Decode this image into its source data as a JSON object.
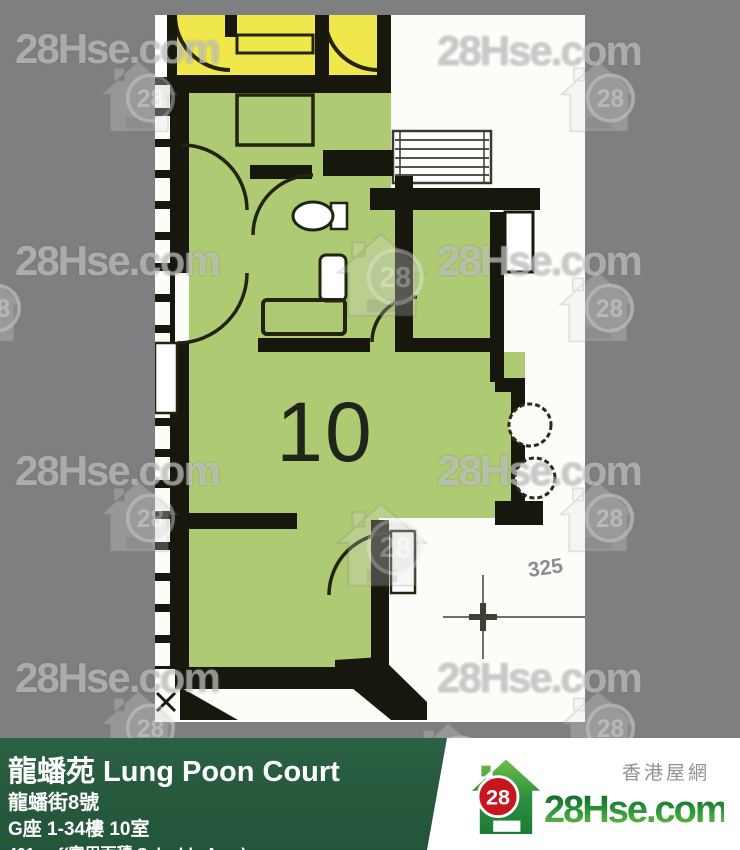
{
  "watermark": {
    "text": "28Hse.com",
    "badge": "28"
  },
  "plan": {
    "unit_number": "10",
    "dimension": "325"
  },
  "banner": {
    "title": "龍蟠苑 Lung Poon Court",
    "address": "龍蟠街8號",
    "unit": "G座 1-34樓 10室",
    "area": "401 sqf(實用面積 Saleable Area)"
  },
  "logo": {
    "site_zh": "香港屋網",
    "site": "28Hse.com",
    "badge": "28"
  },
  "colors": {
    "background_gray": "#7f7f82",
    "banner_green": "#27593d",
    "plan_green": "#aeca72",
    "plan_yellow": "#efe74b",
    "wall_black": "#17170e",
    "logo_red": "#c9151e",
    "logo_green": "#2f9a3c"
  }
}
